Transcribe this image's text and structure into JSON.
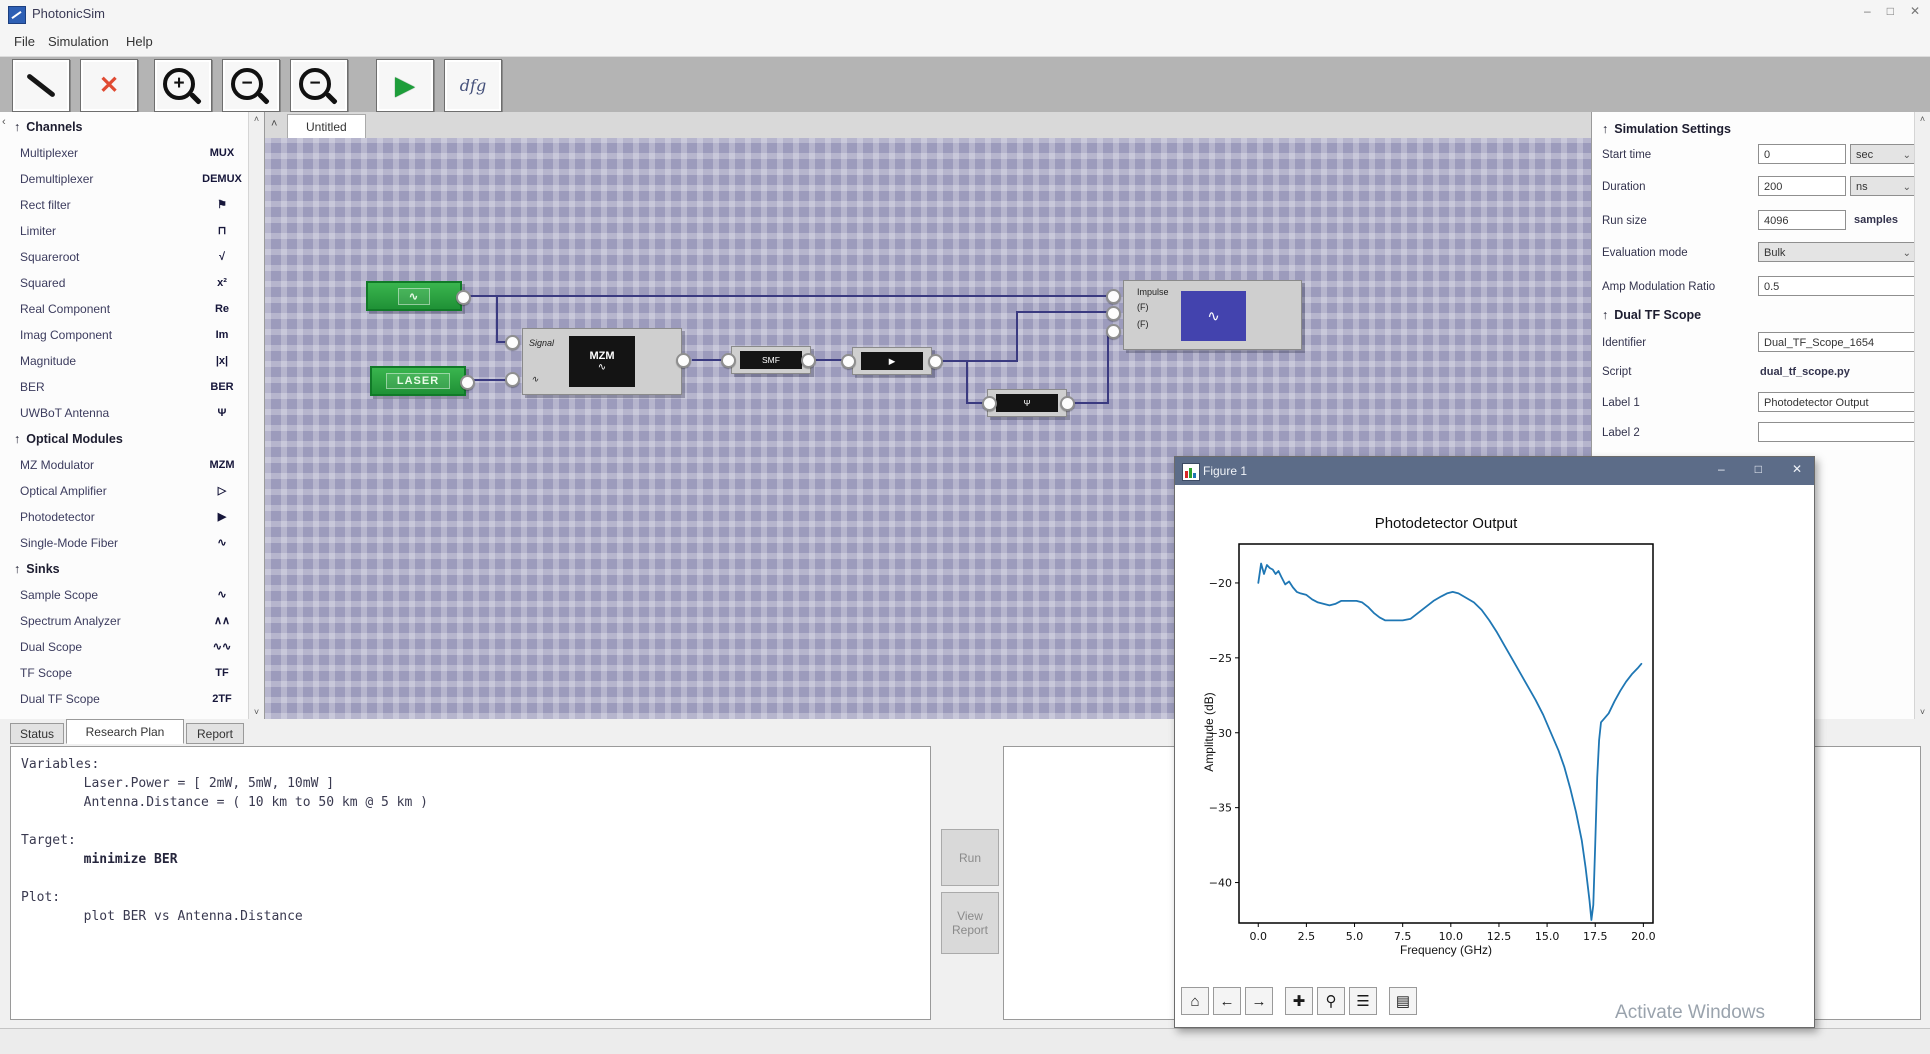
{
  "window": {
    "title": "PhotonicSim",
    "minimize": "–",
    "maximize": "□",
    "close": "✕"
  },
  "menu": {
    "items": [
      "File",
      "Simulation",
      "Help"
    ]
  },
  "toolbar": {
    "delete_glyph": "✕",
    "zoom_in_sign": "+",
    "zoom_out_sign": "−",
    "zoom_out2_sign": "−",
    "run_glyph": "▶",
    "script_label": "dfg"
  },
  "palette": {
    "collapse_arrow": "‹",
    "scroll_up": "˄",
    "scroll_down": "˅",
    "sections": [
      {
        "title": "Channels",
        "items": [
          {
            "label": "Multiplexer",
            "icon": "MUX"
          },
          {
            "label": "Demultiplexer",
            "icon": "DEMUX"
          },
          {
            "label": "Rect filter",
            "icon": "⚑"
          },
          {
            "label": "Limiter",
            "icon": "⊓"
          },
          {
            "label": "Squareroot",
            "icon": "√"
          },
          {
            "label": "Squared",
            "icon": "x²"
          },
          {
            "label": "Real Component",
            "icon": "Re"
          },
          {
            "label": "Imag Component",
            "icon": "Im"
          },
          {
            "label": "Magnitude",
            "icon": "|x|"
          },
          {
            "label": "BER",
            "icon": "BER"
          },
          {
            "label": "UWBoT Antenna",
            "icon": "Ψ"
          }
        ]
      },
      {
        "title": "Optical Modules",
        "items": [
          {
            "label": "MZ Modulator",
            "icon": "MZM"
          },
          {
            "label": "Optical Amplifier",
            "icon": "▷"
          },
          {
            "label": "Photodetector",
            "icon": "▶"
          },
          {
            "label": "Single-Mode Fiber",
            "icon": "∿"
          }
        ]
      },
      {
        "title": "Sinks",
        "items": [
          {
            "label": "Sample Scope",
            "icon": "∿"
          },
          {
            "label": "Spectrum Analyzer",
            "icon": "∧∧"
          },
          {
            "label": "Dual Scope",
            "icon": "∿∿"
          },
          {
            "label": "TF Scope",
            "icon": "TF"
          },
          {
            "label": "Dual TF Scope",
            "icon": "2TF"
          }
        ]
      }
    ]
  },
  "canvas": {
    "tab": "Untitled",
    "collapse_arrow": "˄",
    "blocks": {
      "impulse_source": {
        "label": "∿"
      },
      "laser_source": {
        "label": "LASER"
      },
      "mzm": {
        "title": "MZM",
        "subtitle": "∿",
        "port_signal": "Signal",
        "port_laser": "∿"
      },
      "fiber": {
        "label": "SMF"
      },
      "photodetector": {
        "label": "▶"
      },
      "antenna": {
        "label": "Ψ"
      },
      "scope": {
        "glyph": "∿",
        "port1": "Impulse",
        "port2": "(F)",
        "port3": "(F)"
      }
    }
  },
  "settings": {
    "title": "Simulation Settings",
    "arrow": "↑",
    "start_time": {
      "label": "Start time",
      "value": "0",
      "unit": "sec",
      "chevron": "⌄"
    },
    "duration": {
      "label": "Duration",
      "value": "200",
      "unit": "ns",
      "chevron": "⌄"
    },
    "run_size": {
      "label": "Run size",
      "value": "4096",
      "unit": "samples"
    },
    "evaluation_mode": {
      "label": "Evaluation mode",
      "value": "Bulk",
      "chevron": "⌄"
    },
    "amp_ratio": {
      "label": "Amp Modulation Ratio",
      "value": "0.5"
    }
  },
  "scope_settings": {
    "title": "Dual TF Scope",
    "arrow": "↑",
    "identifier": {
      "label": "Identifier",
      "value": "Dual_TF_Scope_1654"
    },
    "script": {
      "label": "Script",
      "value": "dual_tf_scope.py"
    },
    "label1": {
      "label": "Label 1",
      "value": "Photodetector Output"
    },
    "label2": {
      "label": "Label 2",
      "value": ""
    }
  },
  "bottom": {
    "tabs": [
      "Status",
      "Research Plan",
      "Report"
    ],
    "active_tab": "Research Plan",
    "run_button": "Run",
    "view_report_button": "View Report",
    "plan_lines": [
      {
        "text": "Variables:",
        "bold": false
      },
      {
        "text": "        Laser.Power = [ 2mW, 5mW, 10mW ]",
        "bold": false
      },
      {
        "text": "        Antenna.Distance = ( 10 km to 50 km @ 5 km )",
        "bold": false
      },
      {
        "text": "",
        "bold": false
      },
      {
        "text": "Target:",
        "bold": false
      },
      {
        "text": "        minimize BER",
        "bold": true
      },
      {
        "text": "",
        "bold": false
      },
      {
        "text": "Plot:",
        "bold": false
      },
      {
        "text": "        plot BER vs Antenna.Distance",
        "bold": false
      }
    ]
  },
  "figure": {
    "title": "Figure 1",
    "minimize": "–",
    "maximize": "□",
    "close": "✕",
    "toolbar_icons": [
      "⌂",
      "←",
      "→",
      "✚",
      "⚲",
      "☰",
      "▤"
    ],
    "watermark": "Activate Windows"
  },
  "chart_data": {
    "type": "line",
    "title": "Photodetector Output",
    "xlabel": "Frequency (GHz)",
    "ylabel": "Amplitude (dB)",
    "xlim": [
      -1.0,
      20.5
    ],
    "ylim": [
      -42.7,
      -17.4
    ],
    "x_ticks": [
      0.0,
      2.5,
      5.0,
      7.5,
      10.0,
      12.5,
      15.0,
      17.5,
      20.0
    ],
    "y_ticks": [
      -20,
      -25,
      -30,
      -35,
      -40
    ],
    "grid": false,
    "legend": "none",
    "line_color": "#1f77b4",
    "series": [
      {
        "name": "photodetector_response",
        "points": [
          [
            0.0,
            -20.0
          ],
          [
            0.15,
            -18.7
          ],
          [
            0.3,
            -19.4
          ],
          [
            0.45,
            -18.8
          ],
          [
            0.6,
            -19.0
          ],
          [
            0.75,
            -19.1
          ],
          [
            0.9,
            -19.4
          ],
          [
            1.05,
            -19.2
          ],
          [
            1.2,
            -19.6
          ],
          [
            1.4,
            -20.1
          ],
          [
            1.6,
            -19.9
          ],
          [
            1.8,
            -20.3
          ],
          [
            2.0,
            -20.6
          ],
          [
            2.2,
            -20.7
          ],
          [
            2.5,
            -20.8
          ],
          [
            2.8,
            -21.1
          ],
          [
            3.1,
            -21.3
          ],
          [
            3.4,
            -21.4
          ],
          [
            3.7,
            -21.5
          ],
          [
            4.0,
            -21.4
          ],
          [
            4.3,
            -21.2
          ],
          [
            4.7,
            -21.2
          ],
          [
            5.1,
            -21.2
          ],
          [
            5.4,
            -21.3
          ],
          [
            5.7,
            -21.6
          ],
          [
            6.0,
            -22.0
          ],
          [
            6.3,
            -22.3
          ],
          [
            6.6,
            -22.5
          ],
          [
            7.0,
            -22.5
          ],
          [
            7.5,
            -22.5
          ],
          [
            7.9,
            -22.4
          ],
          [
            8.3,
            -22.0
          ],
          [
            8.7,
            -21.6
          ],
          [
            9.1,
            -21.2
          ],
          [
            9.5,
            -20.9
          ],
          [
            9.8,
            -20.7
          ],
          [
            10.1,
            -20.6
          ],
          [
            10.4,
            -20.7
          ],
          [
            10.8,
            -21.0
          ],
          [
            11.2,
            -21.3
          ],
          [
            11.6,
            -21.8
          ],
          [
            12.0,
            -22.5
          ],
          [
            12.4,
            -23.3
          ],
          [
            12.8,
            -24.2
          ],
          [
            13.2,
            -25.1
          ],
          [
            13.6,
            -26.0
          ],
          [
            14.0,
            -26.9
          ],
          [
            14.4,
            -27.8
          ],
          [
            14.8,
            -28.8
          ],
          [
            15.2,
            -30.0
          ],
          [
            15.6,
            -31.2
          ],
          [
            15.9,
            -32.3
          ],
          [
            16.2,
            -33.7
          ],
          [
            16.5,
            -35.3
          ],
          [
            16.8,
            -37.2
          ],
          [
            17.0,
            -39.0
          ],
          [
            17.2,
            -41.2
          ],
          [
            17.3,
            -42.5
          ],
          [
            17.4,
            -41.5
          ],
          [
            17.5,
            -37.5
          ],
          [
            17.6,
            -33.0
          ],
          [
            17.7,
            -30.5
          ],
          [
            17.8,
            -29.3
          ],
          [
            18.0,
            -29.0
          ],
          [
            18.2,
            -28.7
          ],
          [
            18.5,
            -27.9
          ],
          [
            18.8,
            -27.2
          ],
          [
            19.1,
            -26.6
          ],
          [
            19.4,
            -26.1
          ],
          [
            19.7,
            -25.7
          ],
          [
            19.9,
            -25.4
          ]
        ]
      }
    ]
  }
}
